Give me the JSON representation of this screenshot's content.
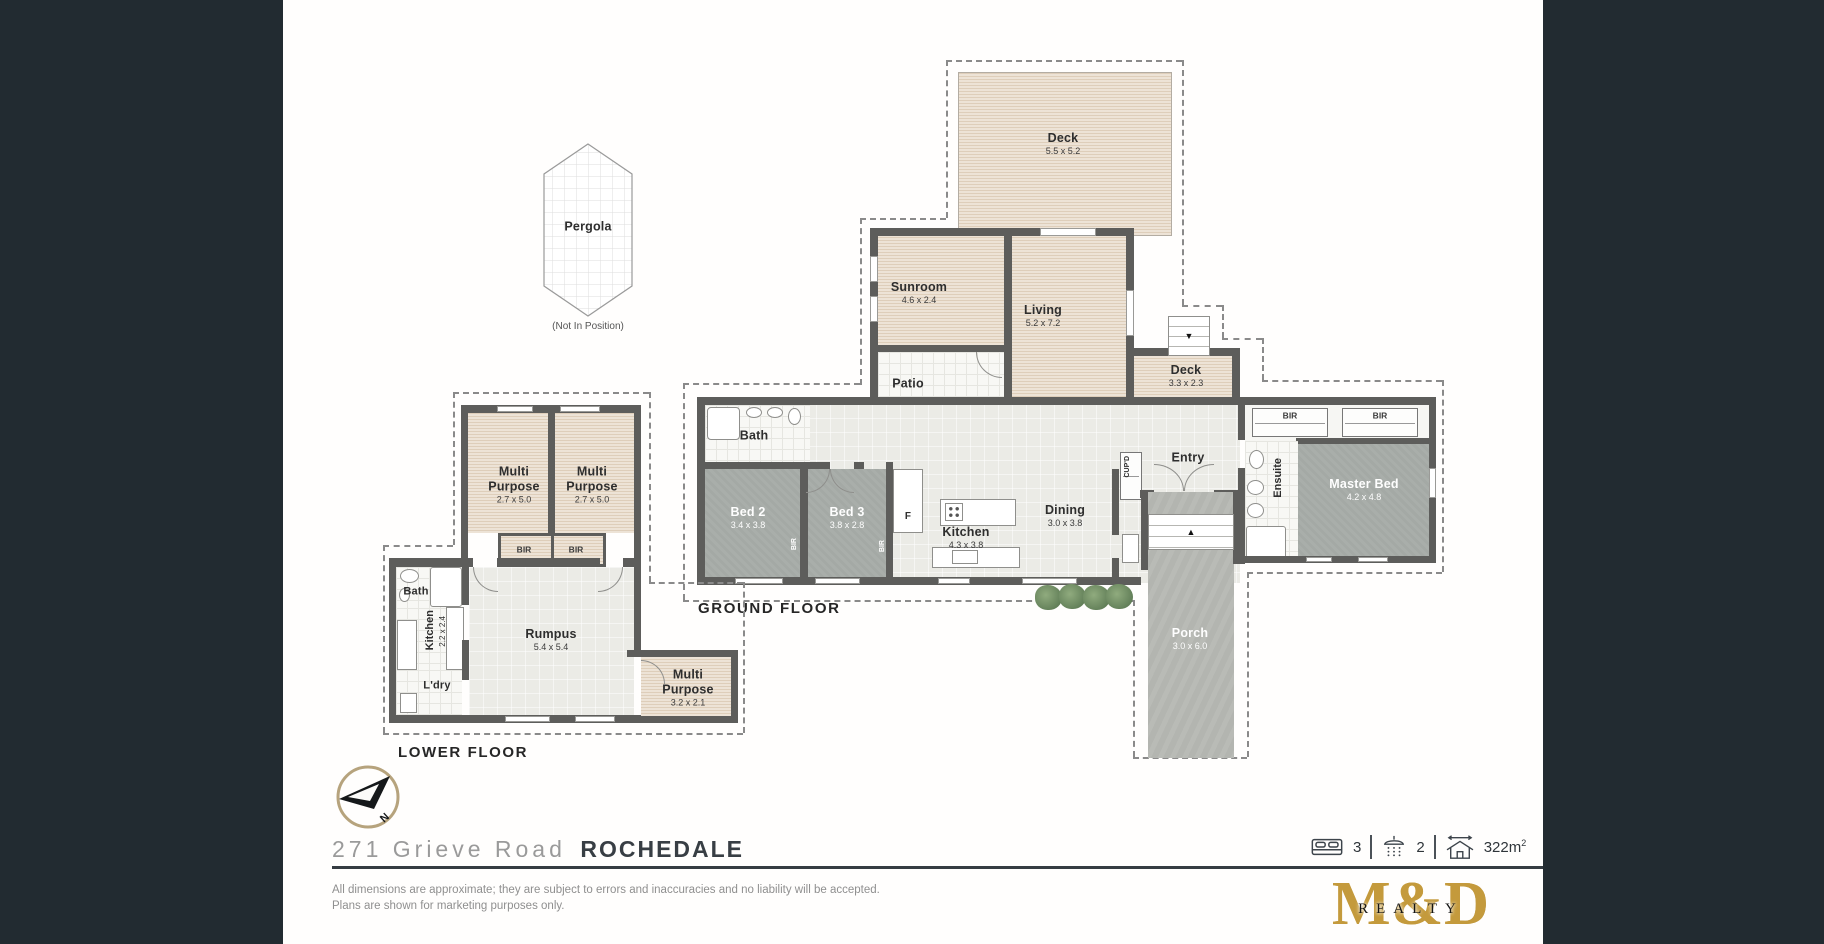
{
  "colors": {
    "sidebar_band": "#222b31",
    "logo_gold": "#c49a3c",
    "compass_ring": "#b6a37d",
    "wall": "#5d5d5b"
  },
  "pergola": {
    "label": "Pergola",
    "note": "(Not In Position)"
  },
  "ground_floor": {
    "title": "GROUND FLOOR",
    "rooms": {
      "deck_top": {
        "name": "Deck",
        "dims": "5.5 x 5.2"
      },
      "sunroom": {
        "name": "Sunroom",
        "dims": "4.6 x 2.4"
      },
      "living": {
        "name": "Living",
        "dims": "5.2 x 7.2"
      },
      "patio": {
        "name": "Patio"
      },
      "deck_side": {
        "name": "Deck",
        "dims": "3.3 x 2.3"
      },
      "bath": {
        "name": "Bath"
      },
      "bed2": {
        "name": "Bed 2",
        "dims": "3.4 x 3.8"
      },
      "bed3": {
        "name": "Bed 3",
        "dims": "3.8 x 2.8"
      },
      "fridge": {
        "name": "F"
      },
      "kitchen": {
        "name": "Kitchen",
        "dims": "4.3 x 3.8"
      },
      "dining": {
        "name": "Dining",
        "dims": "3.0 x 3.8"
      },
      "entry": {
        "name": "Entry"
      },
      "cupboard": {
        "name": "CUP'D"
      },
      "ensuite": {
        "name": "Ensuite"
      },
      "master_bed": {
        "name": "Master Bed",
        "dims": "4.2 x 4.8"
      },
      "bir_left": {
        "name": "BIR"
      },
      "bir_right": {
        "name": "BIR"
      },
      "bir_bed2": {
        "name": "BIR"
      },
      "bir_bed3": {
        "name": "BIR"
      },
      "porch": {
        "name": "Porch",
        "dims": "3.0 x 6.0"
      }
    }
  },
  "lower_floor": {
    "title": "LOWER FLOOR",
    "rooms": {
      "multi1": {
        "name": "Multi Purpose",
        "dims": "2.7 x 5.0"
      },
      "multi2": {
        "name": "Multi Purpose",
        "dims": "2.7 x 5.0"
      },
      "bir1": {
        "name": "BIR"
      },
      "bir2": {
        "name": "BIR"
      },
      "bath": {
        "name": "Bath"
      },
      "kitchen": {
        "name": "Kitchen",
        "dims": "2.2 x 2.4"
      },
      "rumpus": {
        "name": "Rumpus",
        "dims": "5.4 x 5.4"
      },
      "laundry": {
        "name": "L'dry"
      },
      "multi3": {
        "name": "Multi Purpose",
        "dims": "3.2 x 2.1"
      }
    }
  },
  "compass": {
    "north": "N"
  },
  "footer": {
    "address_street": "271 Grieve Road",
    "address_suburb": "ROCHEDALE",
    "disclaimer_line1": "All dimensions are approximate; they are subject to errors and inaccuracies and no liability will be accepted.",
    "disclaimer_line2": "Plans are shown for marketing purposes only.",
    "stats": {
      "beds": "3",
      "baths": "2",
      "area": "322m",
      "area_sup": "2"
    },
    "logo": {
      "wordmark": "M&D",
      "realty": "REALTY"
    }
  }
}
